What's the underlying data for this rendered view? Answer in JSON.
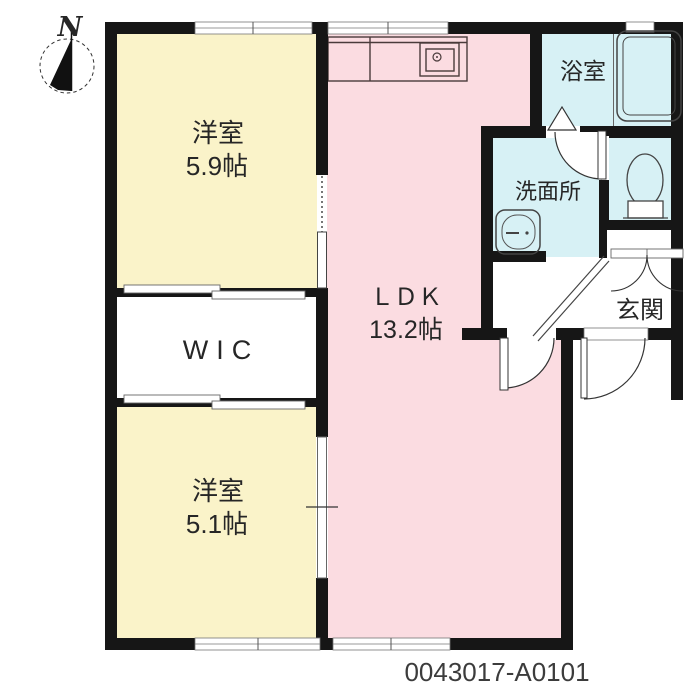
{
  "title": "floorplan",
  "compass": {
    "label": "N"
  },
  "rooms": {
    "bedroom1": {
      "name": "洋室",
      "size": "5.9帖"
    },
    "wic": {
      "name": "WIC"
    },
    "bedroom2": {
      "name": "洋室",
      "size": "5.1帖"
    },
    "ldk": {
      "name": "ＬＤＫ",
      "size": "13.2帖"
    },
    "bathroom": {
      "name": "浴室"
    },
    "washroom": {
      "name": "洗面所"
    },
    "entrance": {
      "name": "玄関"
    }
  },
  "footer": {
    "id": "0043017-A0101"
  },
  "colors": {
    "bedroom_fill": "#faf3c9",
    "ldk_fill": "#fbdce1",
    "wet_fill": "#d7f1f5",
    "wall": "#161616",
    "text": "#262626"
  }
}
